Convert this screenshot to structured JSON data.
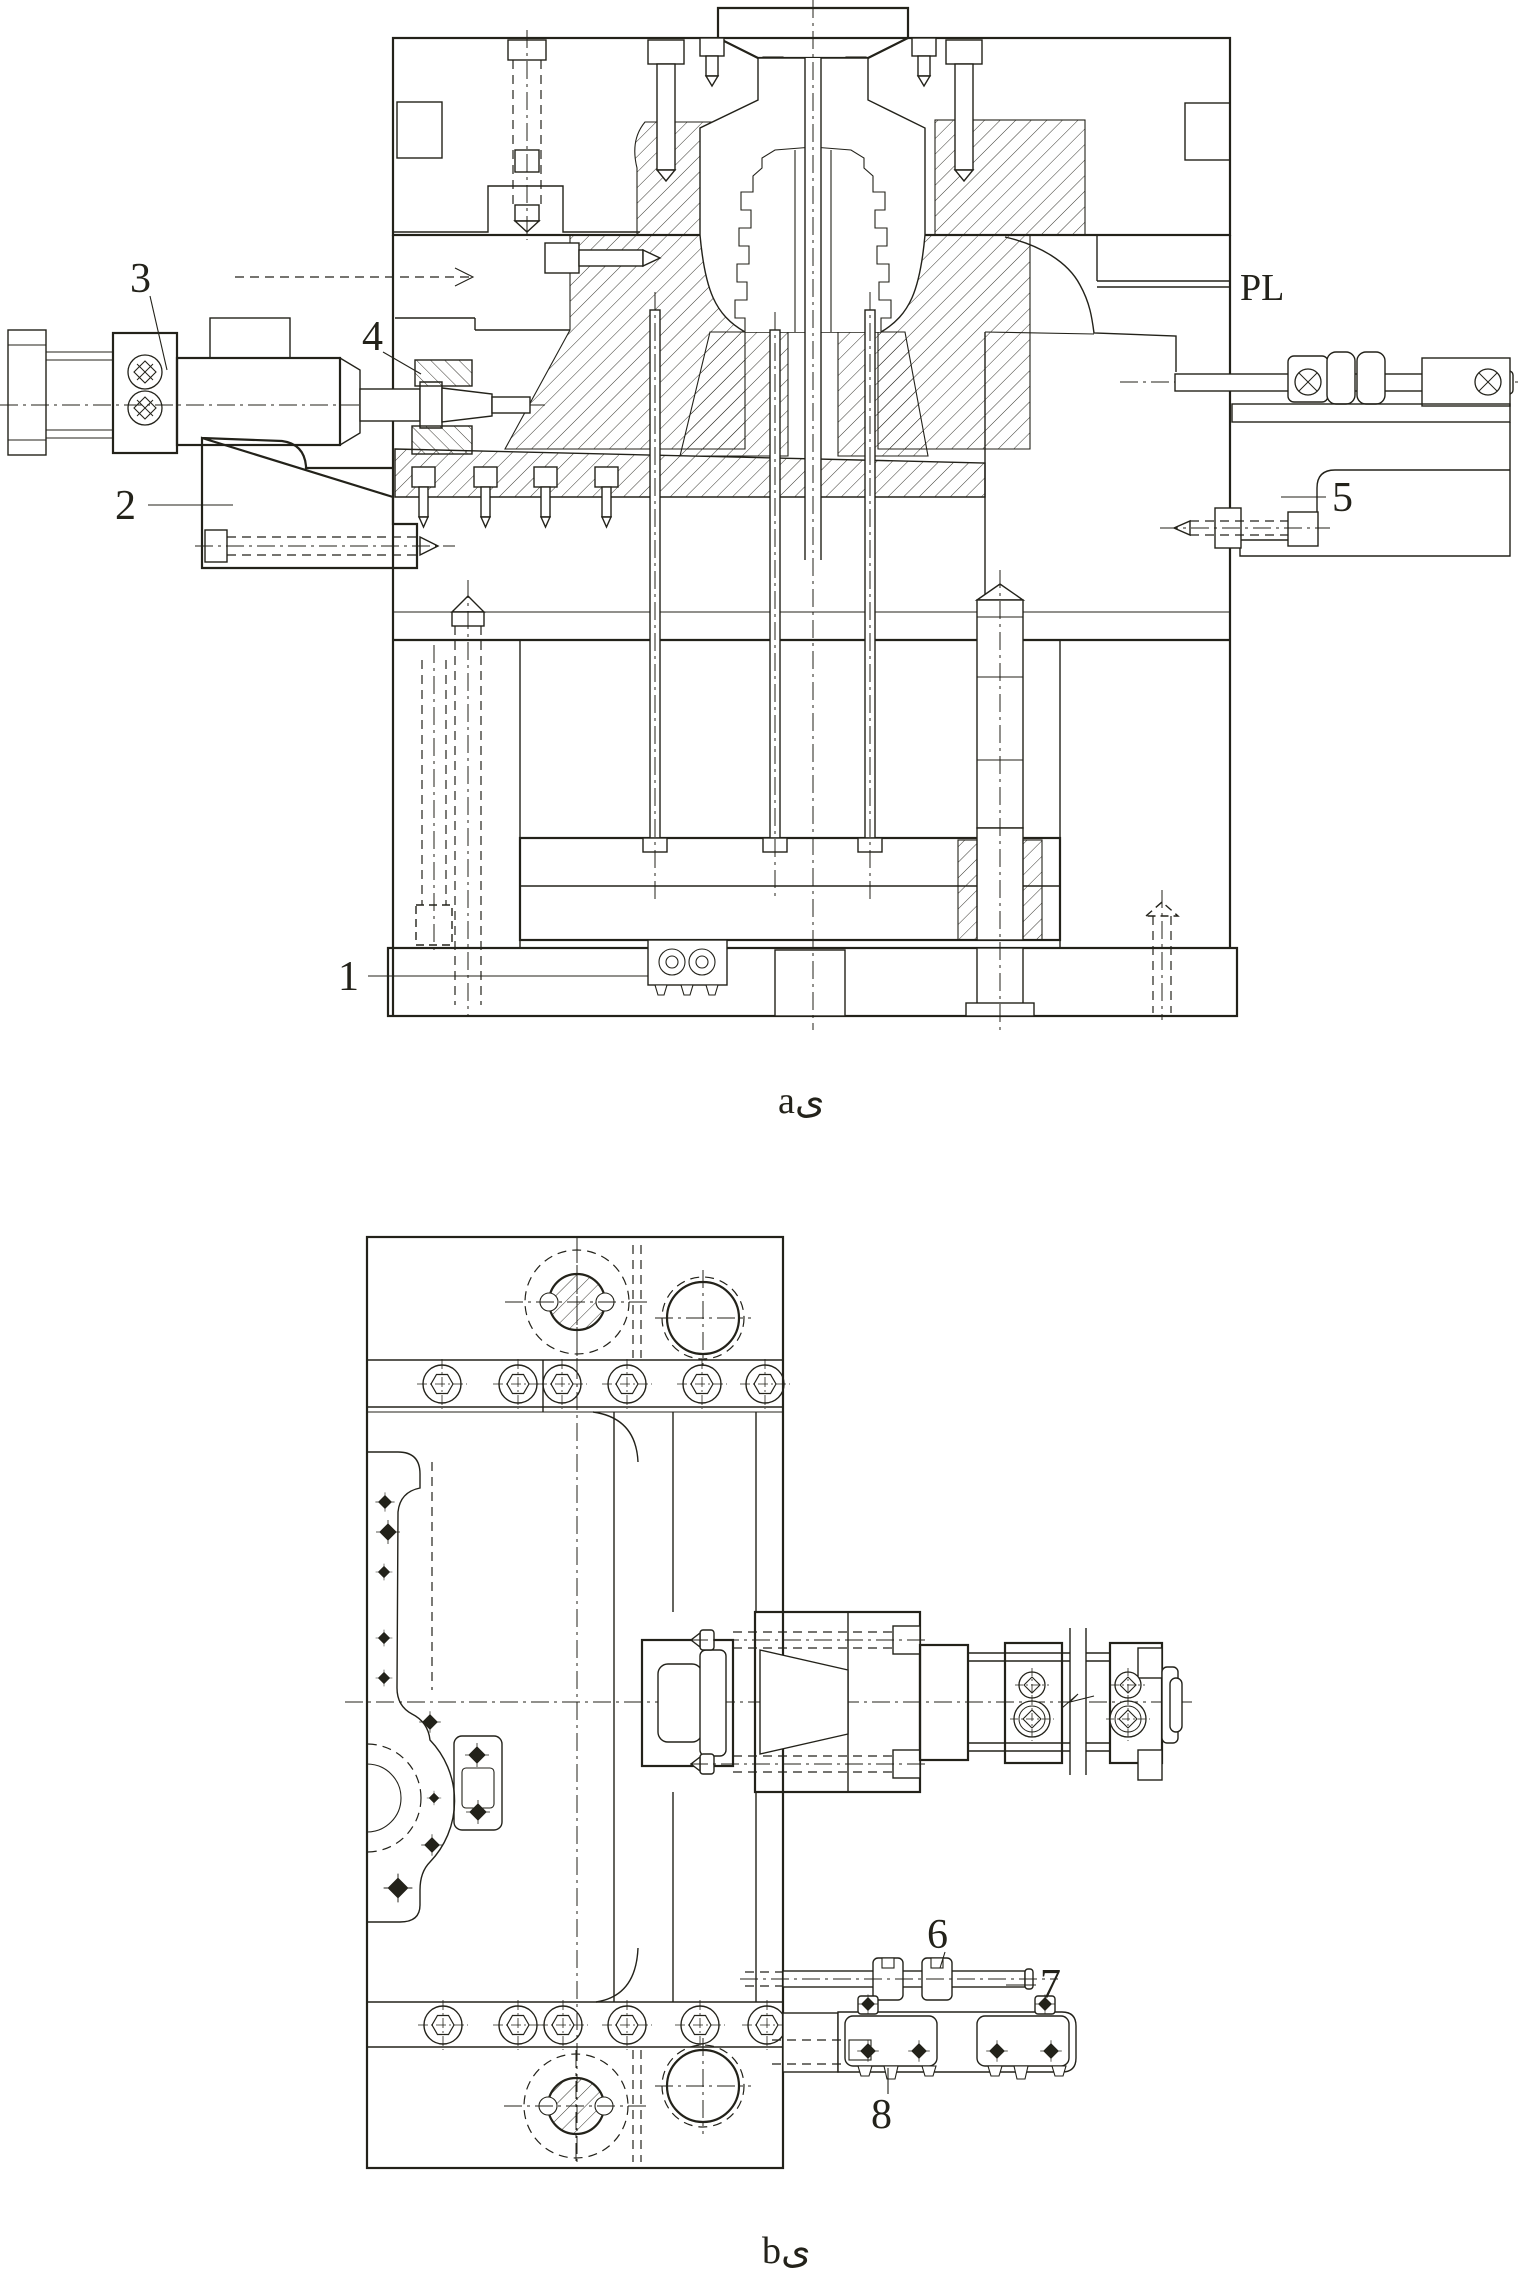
{
  "colors": {
    "background": "#ffffff",
    "ink": "#23221a"
  },
  "view_a": {
    "caption": "aى",
    "parting_line_label": "PL",
    "callouts": {
      "c1": "1",
      "c2": "2",
      "c3": "3",
      "c4": "4",
      "c5": "5"
    }
  },
  "view_b": {
    "caption": "bى",
    "callouts": {
      "c6": "6",
      "c7": "7",
      "c8": "8"
    }
  }
}
